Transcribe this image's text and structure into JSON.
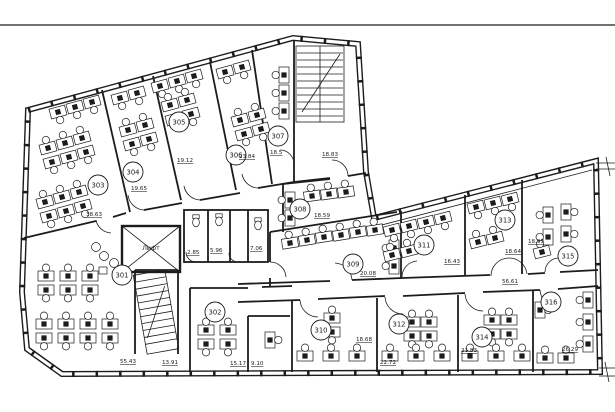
{
  "colors": {
    "background": "#ffffff",
    "line": "#1c1c1c"
  },
  "elevator_label": "Лифт",
  "rooms": [
    {
      "number": "301",
      "area": "55.43"
    },
    {
      "number": "302",
      "area": "15.17"
    },
    {
      "number": "303",
      "area": "38.63"
    },
    {
      "number": "304",
      "area": "19.65"
    },
    {
      "number": "305",
      "area": "19.12"
    },
    {
      "number": "306",
      "area": "23.84"
    },
    {
      "number": "307",
      "area": "18.5"
    },
    {
      "number": "308",
      "area": "18.59"
    },
    {
      "number": "309",
      "area": "20.08"
    },
    {
      "number": "310",
      "area": "18.68"
    },
    {
      "number": "311",
      "area": "16.43"
    },
    {
      "number": "312",
      "area": "22.72"
    },
    {
      "number": "313",
      "area": "18.64"
    },
    {
      "number": "314",
      "area": "21.83"
    },
    {
      "number": "315",
      "area": "18.93"
    },
    {
      "number": "316",
      "area": "26.29"
    }
  ],
  "aux": {
    "stair_area": "13.91",
    "upper_hall": "18.83",
    "corridor": "56.61",
    "annex": "9.10",
    "wc_small": "2.85",
    "wc_mid": "5.96",
    "wc_large": "7.06"
  }
}
